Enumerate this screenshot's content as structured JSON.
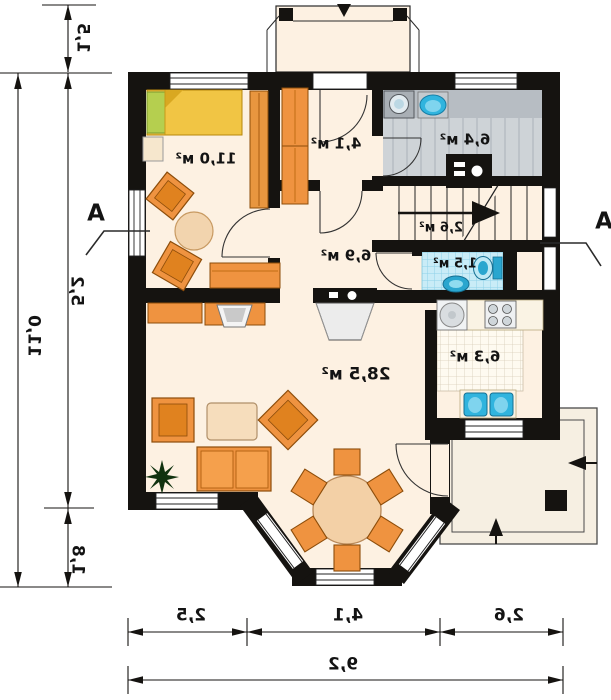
{
  "title": "floor-plan-ground-level",
  "rooms": {
    "bedroom": {
      "area": "11,0 м²"
    },
    "entry_hall": {
      "area": "4,1 м²"
    },
    "bathroom": {
      "area": "6,4 м²"
    },
    "stairs": {
      "area": "2,6 м²"
    },
    "wc": {
      "area": "1,5 м²"
    },
    "hall": {
      "area": "6,9 м²"
    },
    "kitchen": {
      "area": "6,3 м²"
    },
    "living_room": {
      "area": "28,5 м²"
    }
  },
  "dimensions": {
    "porch_depth": "1,5",
    "left_total": "11,0",
    "left_upper": "5,2",
    "left_lower": "1,8",
    "bottom_left": "2,5",
    "bottom_middle": "4,1",
    "bottom_right": "2,6",
    "bottom_total": "9,2"
  },
  "section_markers": {
    "left": "A",
    "right": "A"
  },
  "colors": {
    "wall": "#151310",
    "floor": "#fdf1e2",
    "furniture_orange": "#ef9340",
    "bed_yellow": "#f1c544",
    "pillow_green": "#b5cf4f",
    "bath_tile": "#ced3d7",
    "wc_tile": "#c3e9f5",
    "fixture_cyan": "#30b4de",
    "terrace_floor": "#f6efe2"
  }
}
